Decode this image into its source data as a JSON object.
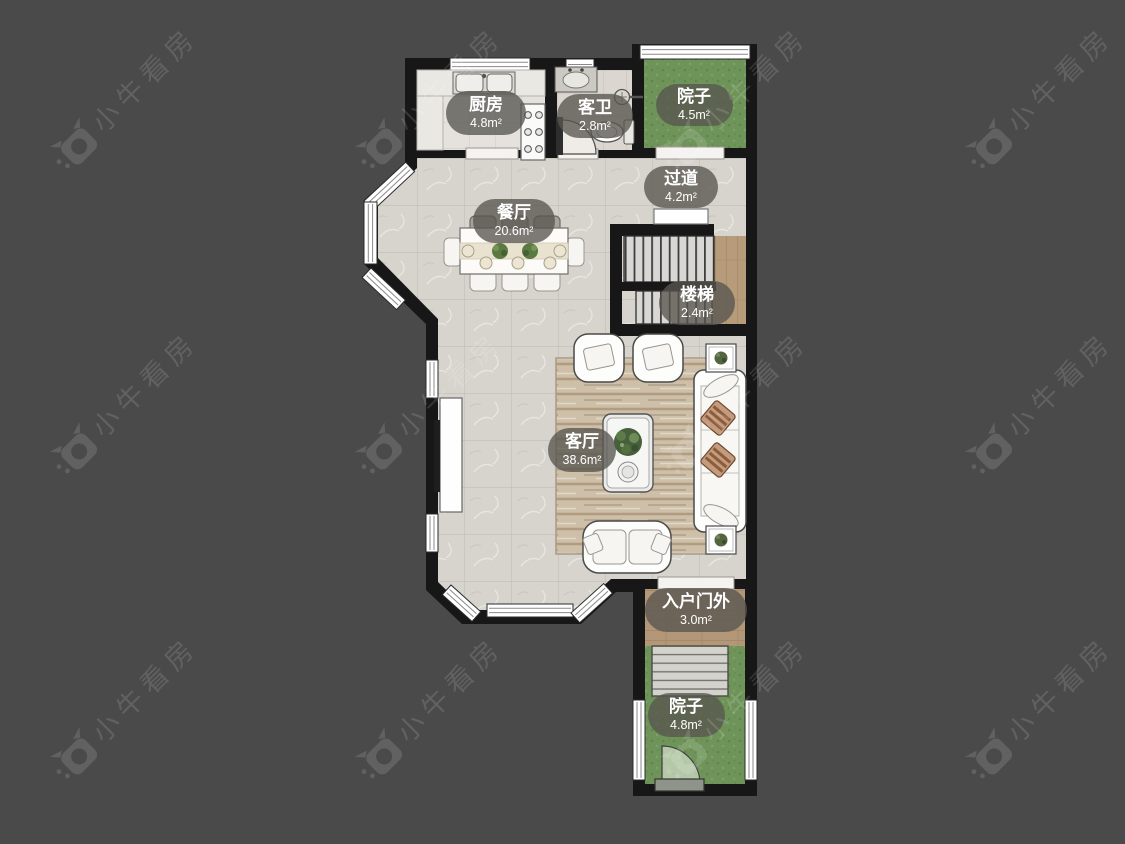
{
  "watermark": {
    "text": "小牛看房"
  },
  "colors": {
    "background": "#4a4a4a",
    "wall": "#171717",
    "floor_tile": "#d7d4ce",
    "kitchen_tile": "#e5e2dd",
    "bath_tile": "#dbd6cf",
    "grass_green": "#6f9459",
    "wood": "#b79c7c",
    "rug": "#cdbfa8",
    "label_pill": "rgba(88,86,80,0.78)",
    "label_text": "#ffffff"
  },
  "floorplan": {
    "rooms": [
      {
        "name": "厨房",
        "area": "4.8m²"
      },
      {
        "name": "客卫",
        "area": "2.8m²"
      },
      {
        "name": "院子",
        "area": "4.5m²"
      },
      {
        "name": "过道",
        "area": "4.2m²"
      },
      {
        "name": "餐厅",
        "area": "20.6m²"
      },
      {
        "name": "楼梯",
        "area": "2.4m²"
      },
      {
        "name": "客厅",
        "area": "38.6m²"
      },
      {
        "name": "入户门外",
        "area": "3.0m²"
      },
      {
        "name": "院子",
        "area": "4.8m²"
      }
    ]
  }
}
